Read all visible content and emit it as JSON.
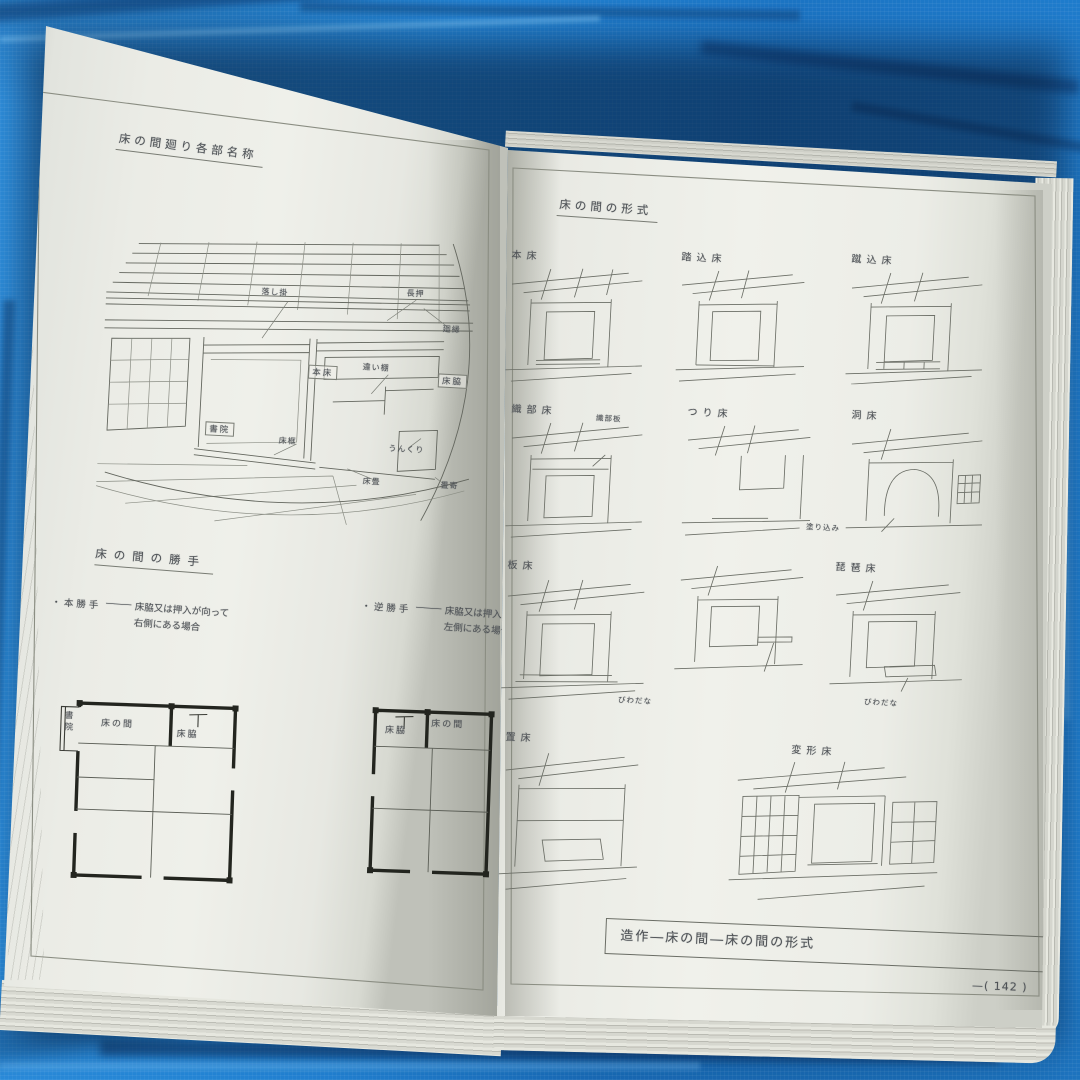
{
  "left_page": {
    "title": "床の間廻り各部名称",
    "labels": {
      "otoshigake": "落し掛",
      "nageshi": "長押",
      "mawaribuchi": "廻縁",
      "hondoko": "本床",
      "chigaidana": "違い棚",
      "tokowaki": "床脇",
      "shoin": "書院",
      "tokogamachi": "床框",
      "unkuri": "うんくり",
      "tokodatami": "床畳",
      "tatamiyose": "畳寄"
    },
    "katte": {
      "title": "床の間の勝手",
      "items": [
        {
          "term": "・本勝手",
          "dash": "———",
          "desc1": "床脇又は押入が向って",
          "desc2": "右側にある場合"
        },
        {
          "term": "・逆勝手",
          "dash": "———",
          "desc1": "床脇又は押入が向って",
          "desc2": "左側にある場合"
        }
      ]
    },
    "plan1": {
      "shoin": "書院",
      "tokonoma": "床の間",
      "tokowaki": "床脇"
    },
    "plan2": {
      "tokowaki": "床脇",
      "tokonoma": "床の間"
    }
  },
  "right_page": {
    "title": "床の間の形式",
    "cells": [
      {
        "name": "本床",
        "sub": ""
      },
      {
        "name": "踏込床",
        "sub": ""
      },
      {
        "name": "蹴込床",
        "sub": ""
      },
      {
        "name": "織部床",
        "sub": "織部板"
      },
      {
        "name": "つり床",
        "sub": ""
      },
      {
        "name": "洞床",
        "sub": "塗り込み"
      },
      {
        "name": "板床",
        "sub": ""
      },
      {
        "name": "",
        "sub": "びわだな"
      },
      {
        "name": "琵琶床",
        "sub": "びわだな"
      },
      {
        "name": "置床",
        "sub": ""
      },
      {
        "name": "変形床",
        "sub": ""
      }
    ],
    "caption": "造作―床の間―床の間の形式",
    "page_number": "—( 142 )"
  }
}
